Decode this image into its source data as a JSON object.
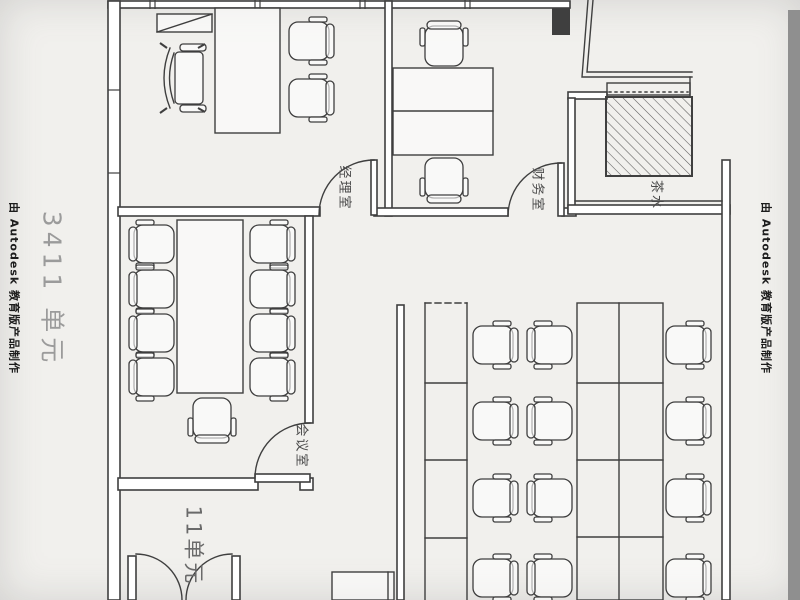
{
  "watermarks": {
    "left_producer": "由 Autodesk 教育版产品制作",
    "right_producer": "由 Autodesk 教育版产品制作",
    "unit_label_large": "3411 单元",
    "unit_label_bottom": "11单元"
  },
  "rooms": {
    "manager_office": "经理室",
    "finance_office": "财务室",
    "meeting_room": "会议室",
    "tea_room": "茶水"
  },
  "colors": {
    "line": "#3f3f3f",
    "background": "#f1f0ed",
    "gray_strip": "#8f8f8f",
    "watermark_gray": "#9b9b9b",
    "label": "#4a4a4a"
  }
}
